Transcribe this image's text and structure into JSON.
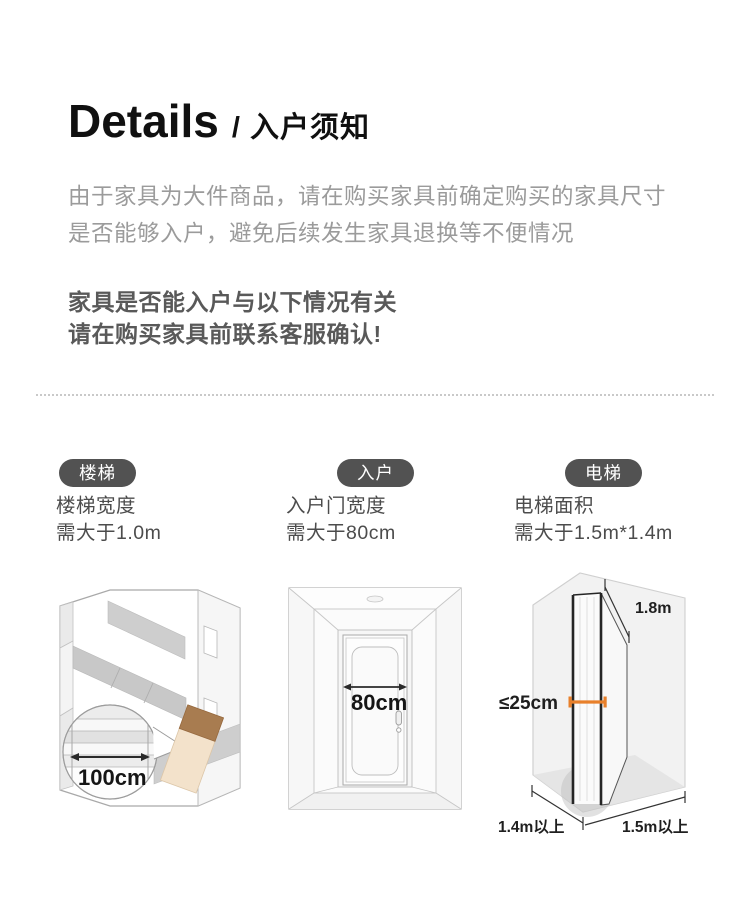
{
  "header": {
    "title": "Details",
    "subtitle": "/ 入户须知"
  },
  "intro": {
    "line1": "由于家具为大件商品，请在购买家具前确定购买的家具尺寸",
    "line2": "是否能够入户，避免后续发生家具退换等不便情况"
  },
  "notice": {
    "line1": "家具是否能入户与以下情况有关",
    "line2": "请在购买家具前联系客服确认!"
  },
  "columns": [
    {
      "badge": "楼梯",
      "desc_line1": "楼梯宽度",
      "desc_line2": "需大于1.0m",
      "measurement": "100cm"
    },
    {
      "badge": "入户",
      "desc_line1": "入户门宽度",
      "desc_line2": "需大于80cm",
      "measurement": "80cm"
    },
    {
      "badge": "电梯",
      "desc_line1": "电梯面积",
      "desc_line2": "需大于1.5m*1.4m",
      "dim_height": "1.8m",
      "dim_thickness": "≤25cm",
      "dim_depth": "1.4m以上",
      "dim_width": "1.5m以上"
    }
  ],
  "colors": {
    "badge_background": "#525252",
    "badge_text": "#ffffff",
    "accent_orange": "#e8802b",
    "box_brown": "#a87c50",
    "box_beige": "#f3e2cb",
    "intro_text": "#9b9b9b",
    "notice_text": "#595959"
  }
}
